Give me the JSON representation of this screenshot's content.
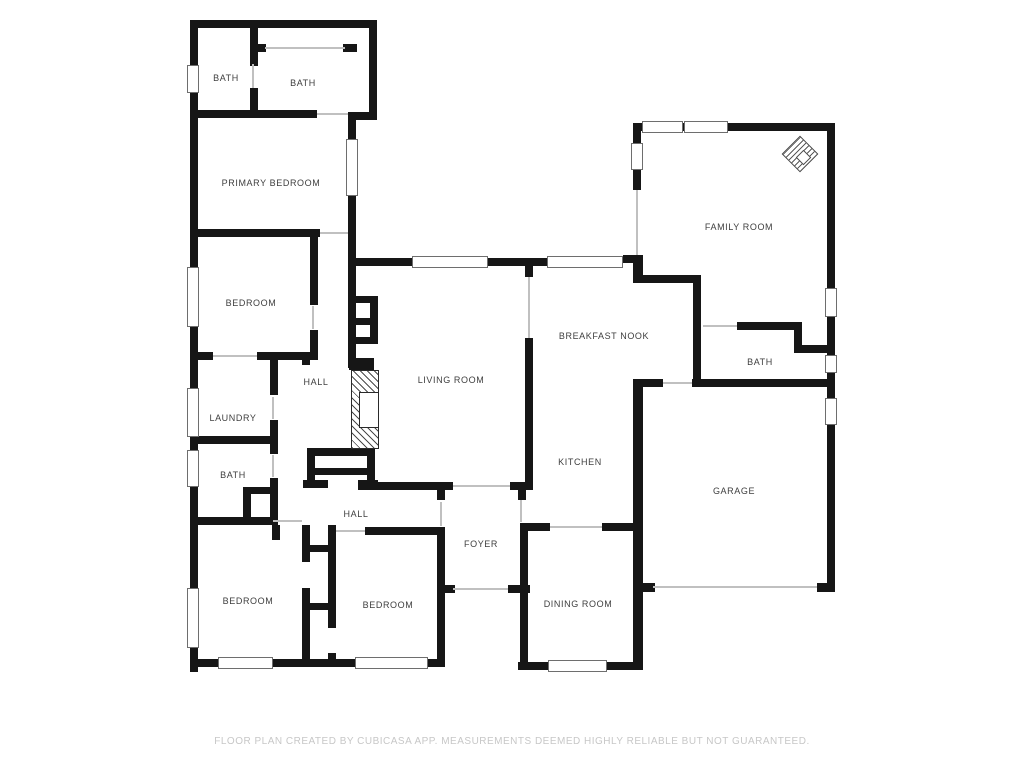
{
  "title": "Floor plan",
  "footer": {
    "text": "FLOOR PLAN CREATED BY CUBICASA APP. MEASUREMENTS DEEMED HIGHLY RELIABLE BUT NOT GUARANTEED."
  },
  "colors": {
    "wall": "#161616",
    "thin_line": "#c0c0c0",
    "window_border": "#6e6e6e",
    "label_text": "#3e3e3e",
    "footer_text": "#c7c7c7",
    "background": "#ffffff"
  },
  "rooms": [
    {
      "id": "bath-1",
      "label": "BATH",
      "x": 226,
      "y": 78
    },
    {
      "id": "bath-2",
      "label": "BATH",
      "x": 303,
      "y": 83
    },
    {
      "id": "primary-bedroom",
      "label": "PRIMARY BEDROOM",
      "x": 271,
      "y": 183
    },
    {
      "id": "bedroom-1",
      "label": "BEDROOM",
      "x": 251,
      "y": 303
    },
    {
      "id": "hall-1",
      "label": "HALL",
      "x": 316,
      "y": 382
    },
    {
      "id": "laundry",
      "label": "LAUNDRY",
      "x": 233,
      "y": 418
    },
    {
      "id": "bath-3",
      "label": "BATH",
      "x": 233,
      "y": 475
    },
    {
      "id": "bedroom-2",
      "label": "BEDROOM",
      "x": 248,
      "y": 601
    },
    {
      "id": "hall-2",
      "label": "HALL",
      "x": 356,
      "y": 514
    },
    {
      "id": "bedroom-3",
      "label": "BEDROOM",
      "x": 388,
      "y": 605
    },
    {
      "id": "living-room",
      "label": "LIVING ROOM",
      "x": 451,
      "y": 380
    },
    {
      "id": "foyer",
      "label": "FOYER",
      "x": 481,
      "y": 544
    },
    {
      "id": "breakfast-nook",
      "label": "BREAKFAST NOOK",
      "x": 604,
      "y": 336
    },
    {
      "id": "kitchen",
      "label": "KITCHEN",
      "x": 580,
      "y": 462
    },
    {
      "id": "dining-room",
      "label": "DINING ROOM",
      "x": 578,
      "y": 604
    },
    {
      "id": "family-room",
      "label": "FAMILY ROOM",
      "x": 739,
      "y": 227
    },
    {
      "id": "bath-4",
      "label": "BATH",
      "x": 760,
      "y": 362
    },
    {
      "id": "garage",
      "label": "GARAGE",
      "x": 734,
      "y": 491
    }
  ],
  "walls": [
    [
      190,
      20,
      8,
      652
    ],
    [
      190,
      20,
      187,
      8
    ],
    [
      369,
      20,
      8,
      100
    ],
    [
      348,
      112,
      29,
      8
    ],
    [
      348,
      112,
      8,
      27
    ],
    [
      348,
      196,
      8,
      70
    ],
    [
      250,
      20,
      8,
      46
    ],
    [
      250,
      88,
      8,
      28
    ],
    [
      252,
      44,
      14,
      8
    ],
    [
      343,
      44,
      14,
      8
    ],
    [
      190,
      110,
      127,
      8
    ],
    [
      190,
      229,
      130,
      8
    ],
    [
      348,
      258,
      64,
      8
    ],
    [
      488,
      258,
      59,
      8
    ],
    [
      623,
      255,
      20,
      8
    ],
    [
      633,
      255,
      10,
      28
    ],
    [
      525,
      262,
      8,
      15
    ],
    [
      525,
      338,
      8,
      152
    ],
    [
      358,
      482,
      95,
      8
    ],
    [
      510,
      482,
      23,
      8
    ],
    [
      437,
      490,
      8,
      10
    ],
    [
      518,
      490,
      8,
      10
    ],
    [
      520,
      523,
      8,
      147
    ],
    [
      437,
      585,
      16,
      8
    ],
    [
      508,
      585,
      22,
      8
    ],
    [
      437,
      527,
      8,
      140
    ],
    [
      445,
      585,
      10,
      8
    ],
    [
      520,
      523,
      30,
      8
    ],
    [
      602,
      523,
      41,
      8
    ],
    [
      633,
      379,
      10,
      291
    ],
    [
      518,
      662,
      122,
      8
    ],
    [
      643,
      583,
      12,
      9
    ],
    [
      633,
      379,
      30,
      8
    ],
    [
      692,
      379,
      143,
      8
    ],
    [
      633,
      583,
      20,
      9
    ],
    [
      817,
      583,
      18,
      9
    ],
    [
      827,
      123,
      8,
      469
    ],
    [
      633,
      123,
      202,
      8
    ],
    [
      633,
      123,
      8,
      20
    ],
    [
      633,
      170,
      8,
      20
    ],
    [
      643,
      275,
      54,
      8
    ],
    [
      693,
      275,
      8,
      105
    ],
    [
      737,
      322,
      65,
      8
    ],
    [
      794,
      322,
      8,
      31
    ],
    [
      794,
      345,
      41,
      8
    ],
    [
      310,
      233,
      8,
      72
    ],
    [
      310,
      330,
      8,
      30
    ],
    [
      190,
      352,
      23,
      8
    ],
    [
      257,
      352,
      61,
      8
    ],
    [
      302,
      352,
      8,
      13
    ],
    [
      270,
      360,
      8,
      35
    ],
    [
      270,
      420,
      8,
      24
    ],
    [
      190,
      436,
      88,
      8
    ],
    [
      270,
      444,
      8,
      10
    ],
    [
      270,
      478,
      8,
      47
    ],
    [
      243,
      487,
      8,
      31
    ],
    [
      243,
      487,
      34,
      7
    ],
    [
      190,
      517,
      83,
      8
    ],
    [
      272,
      525,
      8,
      15
    ],
    [
      348,
      266,
      8,
      102
    ],
    [
      356,
      296,
      22,
      7
    ],
    [
      356,
      318,
      22,
      7
    ],
    [
      356,
      337,
      22,
      7
    ],
    [
      370,
      296,
      8,
      46
    ],
    [
      349,
      358,
      25,
      12
    ],
    [
      307,
      448,
      68,
      8
    ],
    [
      307,
      448,
      8,
      40
    ],
    [
      367,
      448,
      8,
      40
    ],
    [
      310,
      468,
      60,
      7
    ],
    [
      303,
      480,
      25,
      8
    ],
    [
      358,
      480,
      20,
      8
    ],
    [
      302,
      525,
      8,
      37
    ],
    [
      302,
      588,
      8,
      79
    ],
    [
      328,
      525,
      8,
      103
    ],
    [
      328,
      653,
      8,
      14
    ],
    [
      308,
      545,
      22,
      7
    ],
    [
      308,
      603,
      22,
      7
    ],
    [
      365,
      527,
      78,
      8
    ],
    [
      190,
      659,
      255,
      8
    ]
  ],
  "windows": [
    [
      187,
      65,
      12,
      28
    ],
    [
      187,
      267,
      12,
      60
    ],
    [
      187,
      388,
      12,
      49
    ],
    [
      187,
      450,
      12,
      37
    ],
    [
      187,
      588,
      12,
      60
    ],
    [
      346,
      139,
      12,
      57
    ],
    [
      412,
      256,
      76,
      12
    ],
    [
      547,
      256,
      76,
      12
    ],
    [
      642,
      121,
      41,
      12
    ],
    [
      684,
      121,
      44,
      12
    ],
    [
      631,
      143,
      12,
      27
    ],
    [
      825,
      288,
      12,
      29
    ],
    [
      825,
      355,
      12,
      18
    ],
    [
      825,
      398,
      12,
      27
    ],
    [
      548,
      660,
      59,
      12
    ],
    [
      218,
      657,
      55,
      12
    ],
    [
      355,
      657,
      73,
      12
    ]
  ],
  "thin_lines": [
    [
      265,
      47,
      80,
      2
    ],
    [
      528,
      277,
      2,
      61
    ],
    [
      636,
      190,
      2,
      65
    ],
    [
      653,
      586,
      164,
      2
    ],
    [
      453,
      588,
      55,
      2
    ],
    [
      320,
      232,
      28,
      2
    ],
    [
      213,
      355,
      44,
      2
    ],
    [
      273,
      520,
      29,
      2
    ],
    [
      336,
      530,
      29,
      2
    ],
    [
      453,
      485,
      57,
      2
    ],
    [
      550,
      526,
      52,
      2
    ],
    [
      663,
      382,
      29,
      2
    ],
    [
      703,
      325,
      34,
      2
    ],
    [
      317,
      113,
      31,
      2
    ],
    [
      252,
      64,
      2,
      24
    ],
    [
      272,
      397,
      2,
      22
    ],
    [
      272,
      455,
      2,
      22
    ],
    [
      312,
      306,
      2,
      23
    ],
    [
      520,
      500,
      2,
      22
    ],
    [
      440,
      502,
      2,
      24
    ]
  ],
  "fireplace": {
    "outer": [
      351,
      370,
      28,
      79
    ],
    "inner": [
      359,
      392,
      20,
      36
    ]
  },
  "compass": {
    "x": 787,
    "y": 141,
    "size": 26,
    "notch_size": 11,
    "notch_x": 798,
    "notch_y": 152
  }
}
